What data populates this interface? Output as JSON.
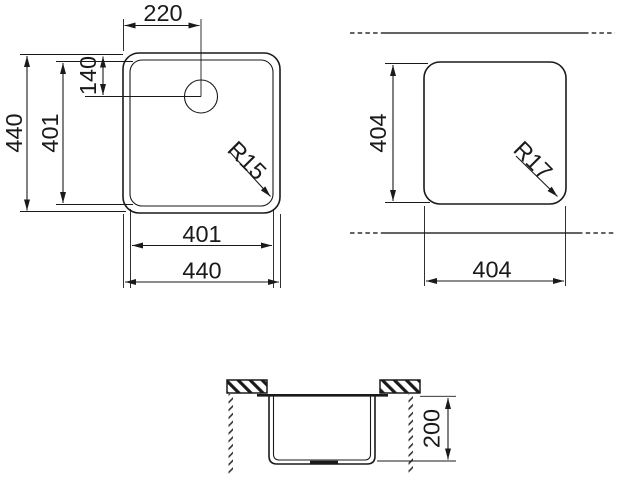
{
  "drawing": {
    "type": "sink-installation-technical-drawing",
    "colors": {
      "line": "#1a1a1a",
      "break_line": "#4d4d4d",
      "background": "#ffffff"
    },
    "top_view": {
      "faucet_offset_x": "220",
      "faucet_offset_y": "140",
      "outer_height": "440",
      "bowl_height": "401",
      "bowl_width": "401",
      "outer_width": "440",
      "corner_radius": "R15"
    },
    "cutout_view": {
      "height": "404",
      "width": "404",
      "corner_radius": "R17"
    },
    "section_view": {
      "depth": "200"
    }
  }
}
